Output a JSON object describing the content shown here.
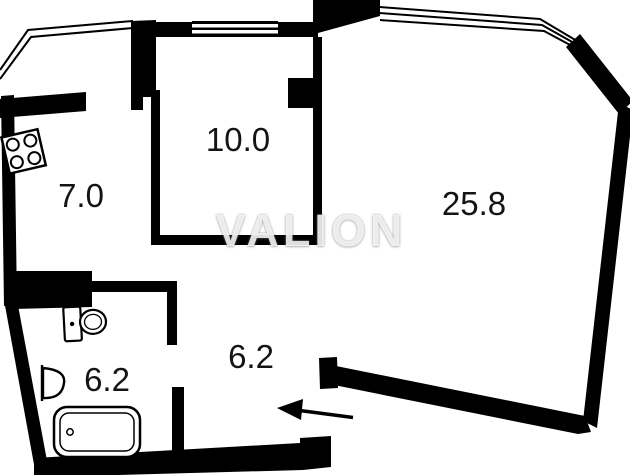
{
  "floorplan": {
    "watermark": "VALION",
    "rooms": {
      "kitchen": {
        "name": "kitchen",
        "area": "7.0"
      },
      "bedroom": {
        "name": "bedroom",
        "area": "10.0"
      },
      "living_room": {
        "name": "living-room",
        "area": "25.8"
      },
      "bathroom": {
        "name": "bathroom",
        "area": "6.2"
      },
      "hallway": {
        "name": "hallway",
        "area": "6.2"
      }
    },
    "fixtures": [
      "stove",
      "toilet",
      "sink",
      "bathtub"
    ],
    "entrance": {
      "direction": "left"
    },
    "colors": {
      "wall": "#000000",
      "background": "#ffffff",
      "label": "#141414",
      "watermark": "#ffffff"
    }
  }
}
